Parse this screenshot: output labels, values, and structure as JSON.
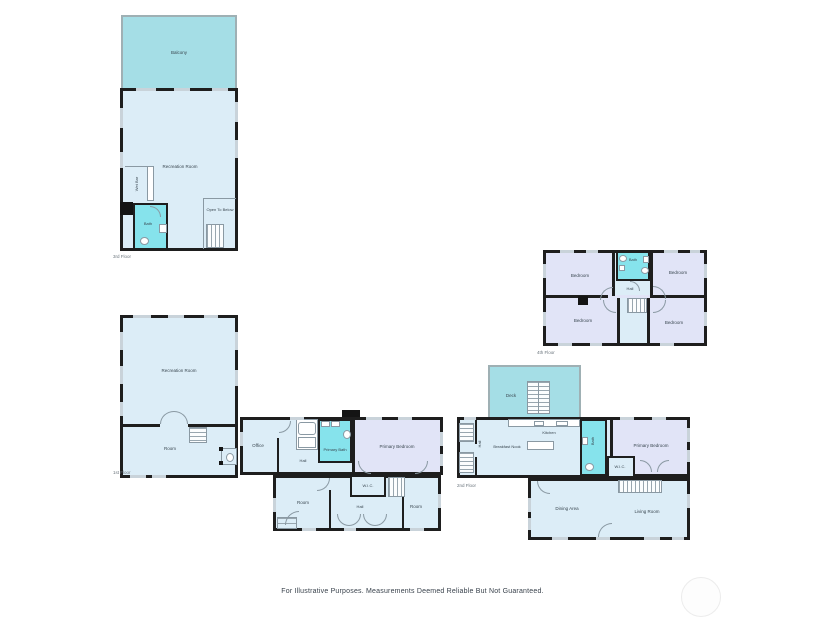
{
  "page": {
    "disclaimer": "For Illustrative Purposes. Measurements Deemed Reliable But Not Guaranteed."
  },
  "colors": {
    "room": "#dcedf7",
    "deck": "#a5dee6",
    "bath": "#86e3ec",
    "bedroom": "#e1e4f7",
    "wall": "#1e1e1e"
  },
  "floors": {
    "third": {
      "label": "3rd Floor",
      "balcony": "Balcony",
      "recreation": "Recreation Room",
      "wet_bar": "Wet Bar",
      "bath": "Bath",
      "open_below": "Open To Below"
    },
    "first": {
      "label": "1st Floor",
      "recreation": "Recreation Room",
      "room": "Room",
      "office": "Office",
      "hall_upper": "Hall",
      "primary_bath": "Primary Bath",
      "primary_bedroom": "Primary Bedroom",
      "wic": "W.I.C.",
      "room_left": "Room",
      "hall_lower": "Hall",
      "room_right": "Room"
    },
    "fourth": {
      "label": "4th Floor",
      "bedroom_tl": "Bedroom",
      "bath": "Bath",
      "bedroom_tr": "Bedroom",
      "hall": "Hall",
      "bedroom_bl": "Bedroom",
      "bedroom_br": "Bedroom"
    },
    "second": {
      "label": "2nd Floor",
      "deck": "Deck",
      "hall": "Hall",
      "breakfast_nook": "Breakfast Nook",
      "kitchen": "Kitchen",
      "bath": "Bath",
      "primary_bedroom": "Primary Bedroom",
      "wic": "W.I.C.",
      "dining": "Dining Area",
      "living": "Living Room"
    }
  }
}
